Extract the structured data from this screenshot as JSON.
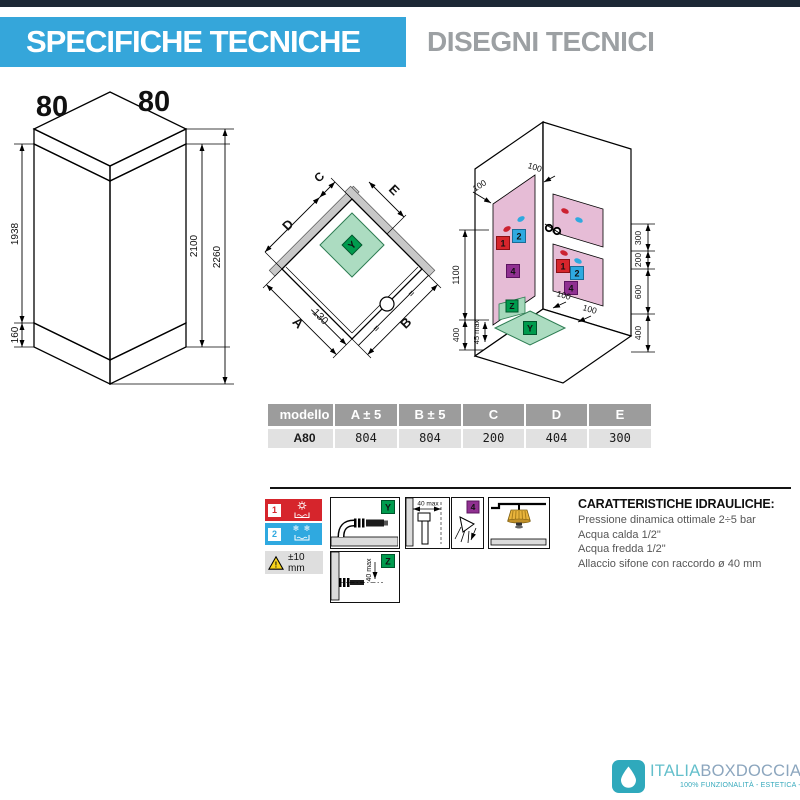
{
  "header": {
    "title": "SPECIFICHE TECNICHE",
    "subtitle": "DISEGNI TECNICI"
  },
  "iso": {
    "top_width": "80",
    "side_width": "80",
    "glass_height": "1938",
    "base_height": "160",
    "door_height": "2100",
    "total_height": "2260"
  },
  "plan": {
    "dim_a": "A",
    "dim_b": "B",
    "dim_c": "C",
    "dim_d": "D",
    "dim_e": "E",
    "offset": "130",
    "equal_left": "=",
    "equal_right": "=",
    "tray_badge": "Y"
  },
  "corner": {
    "wall_left_top": "100",
    "wall_right_top": "100",
    "left_height": "1100",
    "left_base": "400",
    "tray_max": "45 max",
    "right_top": "300",
    "right_upper": "200",
    "right_mid": "600",
    "right_base": "400",
    "floor_a": "100",
    "floor_b": "100",
    "badge_hot": "1",
    "badge_cold": "2",
    "badge_head": "4",
    "badge_z": "Z",
    "badge_y": "Y"
  },
  "table": {
    "headers": [
      "modello",
      "A ± 5",
      "B ± 5",
      "C",
      "D",
      "E"
    ],
    "row": [
      "A80",
      "804",
      "804",
      "200",
      "404",
      "300"
    ]
  },
  "legend": {
    "hot": "1",
    "cold": "2",
    "snow": "❄ ❄",
    "warn": "!",
    "tolerance": "±10 mm",
    "y": "Y",
    "z": "Z",
    "z_dim": "40 max",
    "wall_dim": "40 max",
    "head": "4"
  },
  "hydraulics": {
    "title": "CARATTERISTICHE IDRAULICHE:",
    "line1": "Pressione dinamica ottimale 2÷5 bar",
    "line2": "Acqua calda 1/2\"",
    "line3": "Acqua fredda 1/2\"",
    "line4": "Allaccio sifone con raccordo ø 40 mm"
  },
  "logo": {
    "brand_a": "ITALIA",
    "brand_b": "BOXDOCCIA",
    "tagline": "100% FUNZIONALITÀ - ESTETICA - PRATICITÀ"
  }
}
